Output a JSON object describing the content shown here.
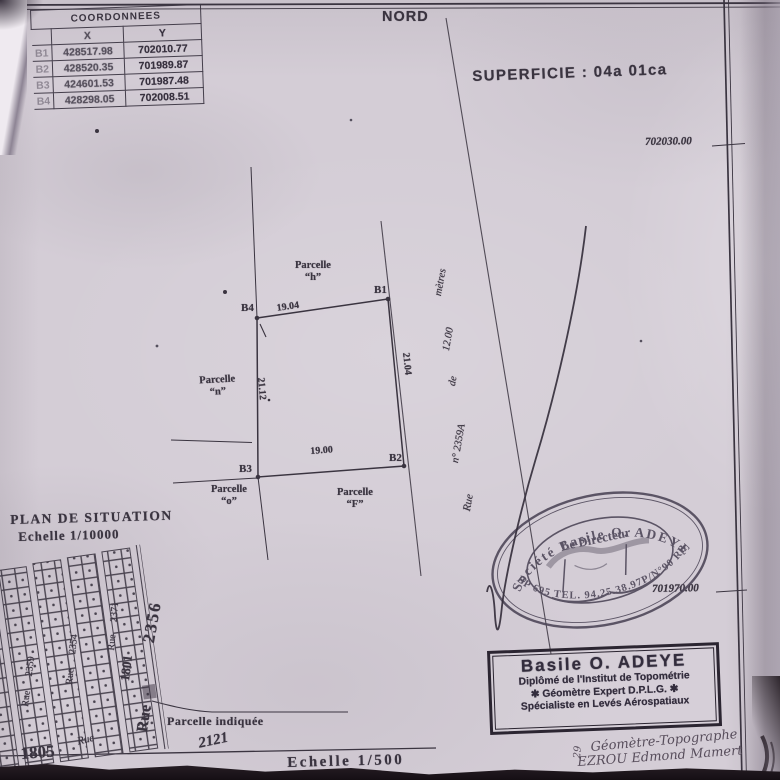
{
  "header": {
    "north_label": "NORD",
    "superficie": "SUPERFICIE : 04a 01ca"
  },
  "coord_table": {
    "title": "COORDONNEES",
    "col_x": "X",
    "col_y": "Y",
    "rows": [
      {
        "pt": "B1",
        "x": "428517.98",
        "y": "702010.77"
      },
      {
        "pt": "B2",
        "x": "428520.35",
        "y": "701989.87"
      },
      {
        "pt": "B3",
        "x": "424601.53",
        "y": "701987.48"
      },
      {
        "pt": "B4",
        "x": "428298.05",
        "y": "702008.51"
      }
    ]
  },
  "grid_labels": {
    "top": "702030.00",
    "bottom": "701970.00"
  },
  "parcel": {
    "corners": [
      "B1",
      "B2",
      "B3",
      "B4"
    ],
    "dims": {
      "top": "19.04",
      "right": "21.04",
      "bottom": "19.00",
      "left": "21.12"
    },
    "labels": {
      "h": [
        "Parcelle",
        "“h”"
      ],
      "n": [
        "Parcelle",
        "“n”"
      ],
      "o": [
        "Parcelle",
        "“o”"
      ],
      "f": [
        "Parcelle",
        "“F”"
      ]
    }
  },
  "road": {
    "words": [
      "Rue",
      "n° 2359A",
      "de",
      "12.00",
      "mètres"
    ]
  },
  "situation": {
    "title": "PLAN DE SITUATION",
    "scale": "Echelle 1/10000",
    "streets": [
      "Rue 2359",
      "Rue 2354",
      "Rue 2371"
    ],
    "lot_1801": "1801",
    "rue_big": "Rue",
    "num_big": "2356",
    "rue_small": "Rue",
    "num_2121": "2121",
    "num_1805": "1805",
    "indicated": "Parcelle indiquée"
  },
  "scale_main": "Echelle 1/500",
  "stamp_oval": {
    "top": "Société Basile O. ADEYE",
    "middle": "Le Directeur",
    "bottom": "BP 695 TEL. 94.25.38.97P/N°90 RB"
  },
  "stamp_box": {
    "lines": [
      "Basile O. ADEYE",
      "Diplômé de l'Institut de Topométrie",
      "✱ Géomètre Expert D.P.L.G. ✱",
      "Spécialiste en Levés Aérospatiaux"
    ]
  },
  "handwriting": {
    "line1": "Géomètre-Topographe",
    "line2": "EZROU Edmond Mamert",
    "side": "29"
  },
  "colors": {
    "ink": "#3a3440",
    "stamp": "#4b4456",
    "paper": "#d4cdd6"
  }
}
